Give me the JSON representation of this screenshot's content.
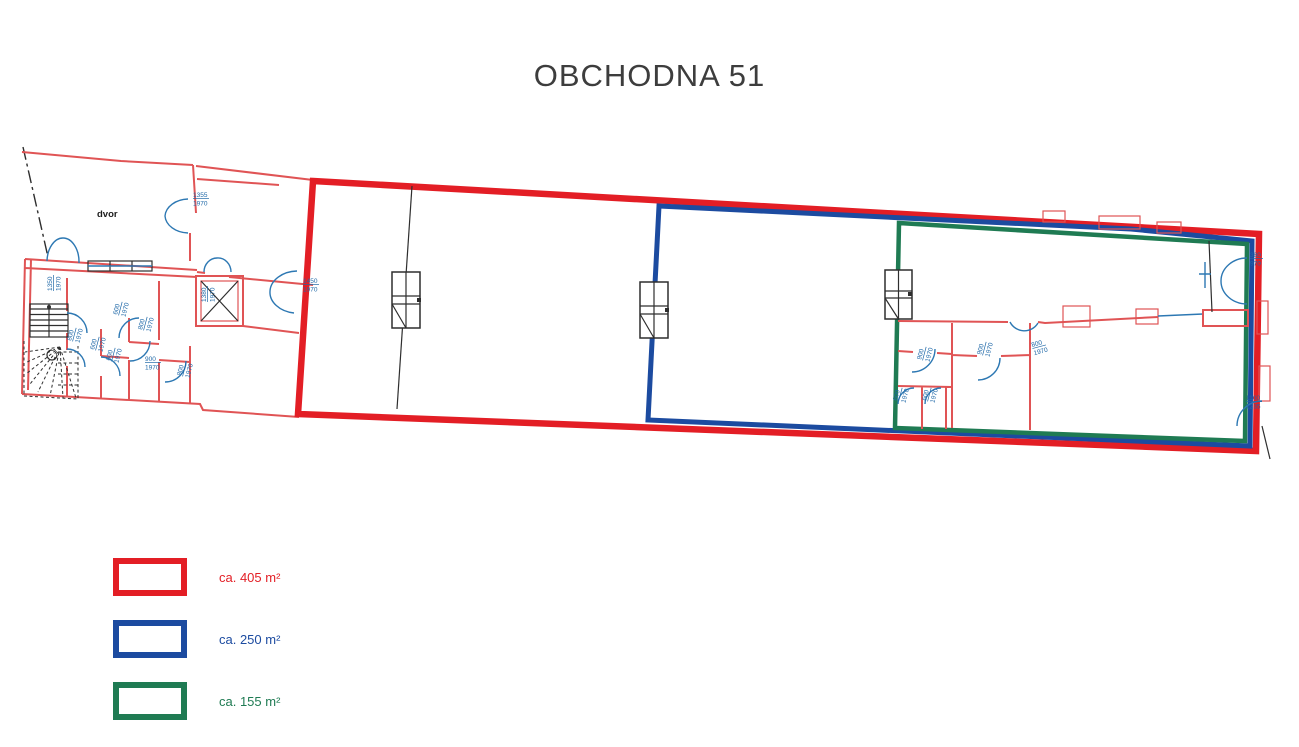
{
  "title": "OBCHODNA 51",
  "colors": {
    "area_red": "#e31e25",
    "area_blue": "#1c4ba0",
    "area_green": "#1f7b53",
    "wall_red": "#e05455",
    "door_blue": "#2d78b3",
    "dim_blue": "#2069a8",
    "line_black": "#2e2e2e",
    "title_gray": "#3d3d3d"
  },
  "plan": {
    "courtyard_label": "dvor",
    "dims": [
      {
        "top": "1355",
        "bottom": "1970"
      },
      {
        "top": "1350",
        "bottom": "1970"
      },
      {
        "top": "1450",
        "bottom": "1970"
      },
      {
        "top": "1380",
        "bottom": "1970"
      },
      {
        "top": "800",
        "bottom": "1970"
      },
      {
        "top": "600",
        "bottom": "1970"
      },
      {
        "top": "600",
        "bottom": "1970"
      },
      {
        "top": "800",
        "bottom": "1970"
      },
      {
        "top": "600",
        "bottom": "1970"
      },
      {
        "top": "900",
        "bottom": "1970"
      },
      {
        "top": "800",
        "bottom": "1970"
      },
      {
        "top": "900",
        "bottom": "1970"
      },
      {
        "top": "900",
        "bottom": "1970"
      },
      {
        "top": "800",
        "bottom": "1970"
      },
      {
        "top": "600",
        "bottom": "1970"
      },
      {
        "top": "600",
        "bottom": "1970"
      },
      {
        "top": "380",
        "bottom": "970"
      },
      {
        "top": "1100",
        "bottom": "1235"
      }
    ]
  },
  "legend": {
    "items": [
      {
        "label": "ca. 405 m²",
        "color": "#e31e25"
      },
      {
        "label": "ca. 250 m²",
        "color": "#1c4ba0"
      },
      {
        "label": "ca. 155 m²",
        "color": "#1f7b53"
      }
    ]
  }
}
